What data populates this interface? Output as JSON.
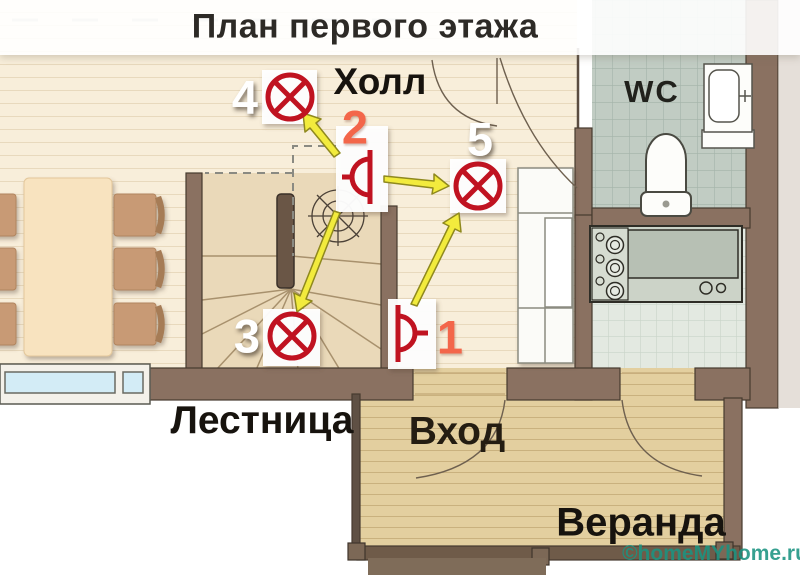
{
  "title": "План первого этажа",
  "rooms": {
    "hall": "Холл",
    "wc": "WC",
    "stairs": "Лестница",
    "entrance": "Вход",
    "veranda": "Веранда"
  },
  "fixtures": {
    "lamp3": {
      "label": "3"
    },
    "lamp4": {
      "label": "4"
    },
    "lamp5": {
      "label": "5"
    },
    "switch1": {
      "label": "1"
    },
    "switch2": {
      "label": "2"
    }
  },
  "watermark": "©homeMYhome.ru",
  "palette": {
    "symbol_red": "#c01321",
    "arrow_yellow": "#f2eb3d",
    "number_orange": "#f3664a",
    "watermark_teal": "#1b9381",
    "wall_brown": "#8a7161",
    "floor_cream": "#f8eeda",
    "floor_tan": "#e3cf9f",
    "wc_tile": "#c1ccc3",
    "kitchen_tile": "#e3e9e1"
  }
}
